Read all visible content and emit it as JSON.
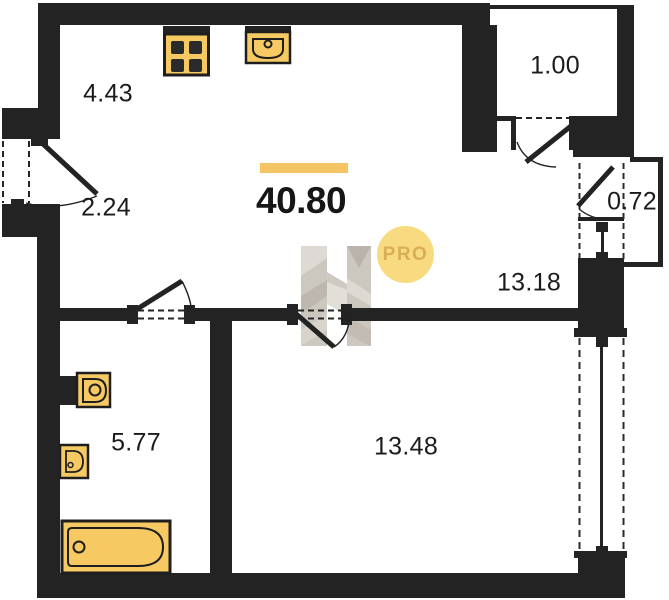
{
  "floorplan": {
    "total_area_label": "40.80",
    "rooms": [
      {
        "name": "kitchen-zone",
        "area_label": "4.43"
      },
      {
        "name": "hallway-zone",
        "area_label": "2.24"
      },
      {
        "name": "wardrobe",
        "area_label": "1.00"
      },
      {
        "name": "vestibule",
        "area_label": "0.72"
      },
      {
        "name": "living-kitchen",
        "area_label": "13.18"
      },
      {
        "name": "bathroom",
        "area_label": "5.77"
      },
      {
        "name": "bedroom",
        "area_label": "13.48"
      }
    ],
    "fixtures": [
      "stove",
      "kitchen-sink",
      "toilet",
      "washbasin",
      "bathtub"
    ],
    "watermark": {
      "badge_label": "PRO"
    },
    "colors": {
      "wall": "#232323",
      "accent_bar": "#F2C464",
      "fixture_fill": "#F6C963",
      "fixture_stroke": "#1E1E1E",
      "badge_bg": "#F8DB80",
      "badge_text": "#D9AE55",
      "watermark_gray": "#CCC7BF"
    }
  }
}
